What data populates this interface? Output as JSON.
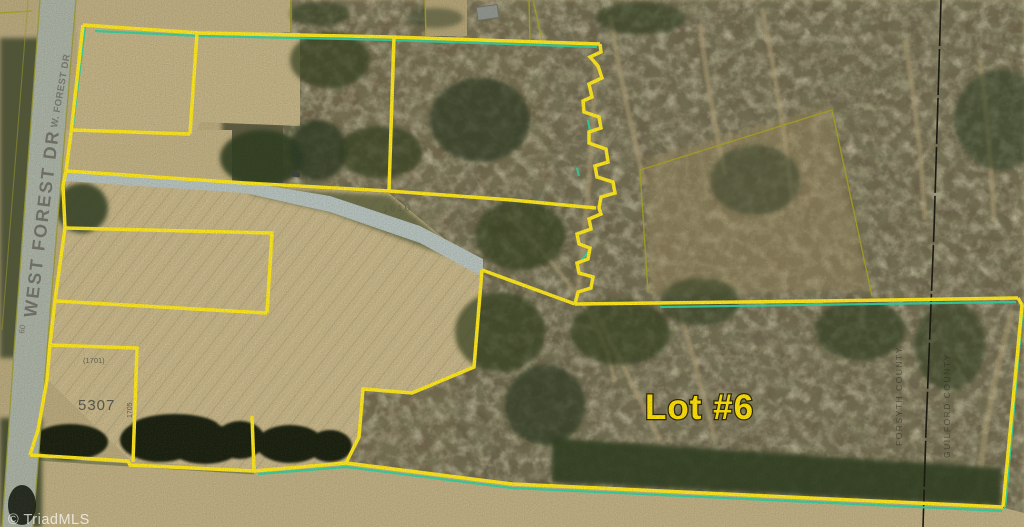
{
  "map": {
    "labels": {
      "lot6": "Lot #6",
      "road_large": "WEST FOREST DR",
      "road_small": "W. FOREST DR",
      "road_width": "60",
      "house_number": "5307",
      "lot_1701": "(1701)",
      "lot_1705": "1705",
      "lot_1610": "1610",
      "county_west": "FORSYTH COUNTY",
      "county_east": "GUILFORD COUNTY",
      "watermark": "© TriadMLS"
    },
    "colors": {
      "boundary_yellow": "#ffe81c",
      "highlight_teal": "#2fd0a0",
      "parcel_olive": "#a8a420",
      "lot_text": "#ffe106",
      "county_line": "#14140e",
      "road_text": "#6a6a62"
    }
  }
}
